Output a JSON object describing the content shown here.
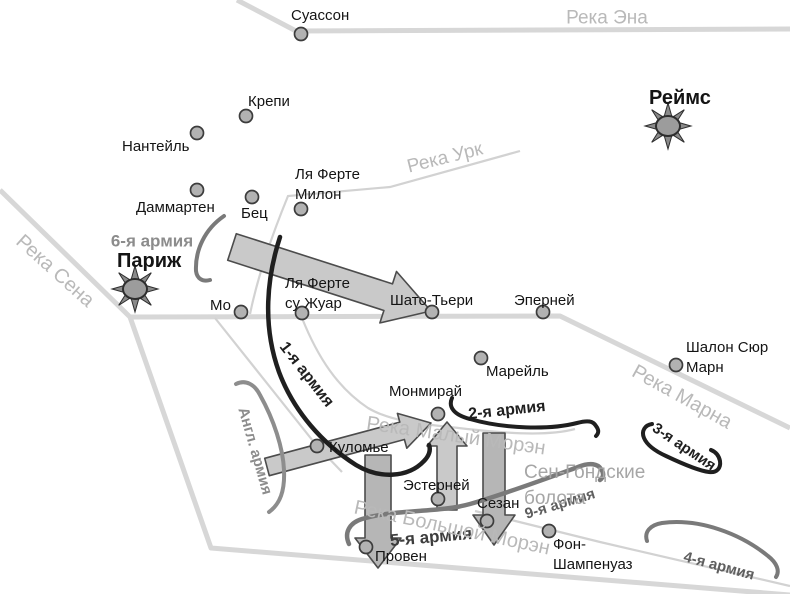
{
  "theme": {
    "background": "#ffffff",
    "river_color": "#d7d7d7",
    "river_thin_color": "#d2d2d2",
    "river_label_color": "#b9b9b9",
    "front_black": "#1f1f1f",
    "front_gray": "#7a7a7a",
    "arrow_fill": "#c9c9c9",
    "arrow_fill_dark": "#b6b6b6",
    "arrow_outline": "#4c4c4c",
    "city_dot_fill": "#b2b2b2",
    "city_dot_border": "#3c3c3c",
    "city_label_color": "#141414",
    "area_label_color": "#a6a6a6"
  },
  "map": {
    "cities": [
      {
        "label": "Суассон",
        "dot": {
          "x": 301,
          "y": 34
        },
        "label_pos": {
          "x": 291,
          "y": 6
        }
      },
      {
        "label": "Крепи",
        "dot": {
          "x": 246,
          "y": 116
        },
        "label_pos": {
          "x": 248,
          "y": 92
        }
      },
      {
        "label": "Нантейль",
        "dot": {
          "x": 197,
          "y": 133
        },
        "label_pos": {
          "x": 122,
          "y": 137
        }
      },
      {
        "label": "Даммартен",
        "dot": {
          "x": 197,
          "y": 190
        },
        "label_pos": {
          "x": 136,
          "y": 198
        }
      },
      {
        "label": "Бец",
        "dot": {
          "x": 252,
          "y": 197
        },
        "label_pos": {
          "x": 241,
          "y": 204
        }
      },
      {
        "label": "Ля Ферте\nМилон",
        "dot": {
          "x": 301,
          "y": 209
        },
        "label_pos": {
          "x": 295,
          "y": 165
        }
      },
      {
        "label": "Мо",
        "dot": {
          "x": 241,
          "y": 312
        },
        "label_pos": {
          "x": 210,
          "y": 296
        }
      },
      {
        "label": "Ля Ферте\nсу Жуар",
        "dot": {
          "x": 302,
          "y": 313
        },
        "label_pos": {
          "x": 285,
          "y": 274
        }
      },
      {
        "label": "Шато-Тьери",
        "dot": {
          "x": 432,
          "y": 312
        },
        "label_pos": {
          "x": 390,
          "y": 291
        }
      },
      {
        "label": "Эперней",
        "dot": {
          "x": 543,
          "y": 312
        },
        "label_pos": {
          "x": 514,
          "y": 291
        }
      },
      {
        "label": "Марейль",
        "dot": {
          "x": 481,
          "y": 358
        },
        "label_pos": {
          "x": 486,
          "y": 362
        }
      },
      {
        "label": "Шалон Сюр\nМарн",
        "dot": {
          "x": 676,
          "y": 365
        },
        "label_pos": {
          "x": 686,
          "y": 338
        }
      },
      {
        "label": "Монмирай",
        "dot": {
          "x": 438,
          "y": 414
        },
        "label_pos": {
          "x": 389,
          "y": 382
        }
      },
      {
        "label": "Куломье",
        "dot": {
          "x": 317,
          "y": 446
        },
        "label_pos": {
          "x": 329,
          "y": 438
        }
      },
      {
        "label": "Эстерней",
        "dot": {
          "x": 438,
          "y": 499
        },
        "label_pos": {
          "x": 403,
          "y": 476
        }
      },
      {
        "label": "Сезан",
        "dot": {
          "x": 487,
          "y": 521
        },
        "label_pos": {
          "x": 477,
          "y": 494
        }
      },
      {
        "label": "Провен",
        "dot": {
          "x": 366,
          "y": 547
        },
        "label_pos": {
          "x": 375,
          "y": 547
        }
      },
      {
        "label": "Фон-\nШампенуаз",
        "dot": {
          "x": 549,
          "y": 531
        },
        "label_pos": {
          "x": 553,
          "y": 535
        }
      },
      {
        "label": "Париж",
        "capital": true,
        "sun": {
          "x": 135,
          "y": 289
        },
        "label_pos": {
          "x": 117,
          "y": 248
        }
      },
      {
        "label": "Реймс",
        "capital": true,
        "sun": {
          "x": 668,
          "y": 126
        },
        "label_pos": {
          "x": 649,
          "y": 85
        }
      }
    ],
    "army_labels": [
      {
        "label": "6-я армия",
        "cx": 152,
        "cy": 241,
        "rot": 0,
        "color": "#8c8c8c",
        "size": 17
      },
      {
        "label": "Англ. армия",
        "cx": 255,
        "cy": 451,
        "rot": 74,
        "color": "#8c8c8c",
        "size": 15
      },
      {
        "label": "1-я армия",
        "cx": 306,
        "cy": 375,
        "rot": 52,
        "color": "#1f1f1f",
        "size": 16
      },
      {
        "label": "2-я армия",
        "cx": 507,
        "cy": 411,
        "rot": -6,
        "color": "#1f1f1f",
        "size": 16
      },
      {
        "label": "3-я армия",
        "cx": 684,
        "cy": 447,
        "rot": 34,
        "color": "#1f1f1f",
        "size": 15
      },
      {
        "label": "4-я армия",
        "cx": 719,
        "cy": 566,
        "rot": 15,
        "color": "#5f5f5f",
        "size": 15
      },
      {
        "label": "5-я армия",
        "cx": 431,
        "cy": 537,
        "rot": -5,
        "color": "#3d3d3d",
        "size": 17
      },
      {
        "label": "9-я армия",
        "cx": 560,
        "cy": 504,
        "rot": -17,
        "color": "#5f5f5f",
        "size": 15
      }
    ],
    "river_labels": [
      {
        "label": "Река Эна",
        "cx": 607,
        "cy": 18,
        "rot": 0,
        "size": 19
      },
      {
        "label": "Река Урк",
        "cx": 445,
        "cy": 158,
        "rot": -14,
        "size": 19
      },
      {
        "label": "Река Сена",
        "cx": 55,
        "cy": 271,
        "rot": 42,
        "size": 20
      },
      {
        "label": "Река Марна",
        "cx": 682,
        "cy": 397,
        "rot": 29,
        "size": 20
      },
      {
        "label": "Река Малый Морэн",
        "cx": 456,
        "cy": 436,
        "rot": 8,
        "size": 20
      },
      {
        "label": "Река Большой Морэн",
        "cx": 452,
        "cy": 528,
        "rot": 12,
        "size": 20
      }
    ],
    "area_labels": [
      {
        "label": "Сен-Гондские\nболота",
        "x": 524,
        "y": 460,
        "size": 19
      }
    ]
  }
}
